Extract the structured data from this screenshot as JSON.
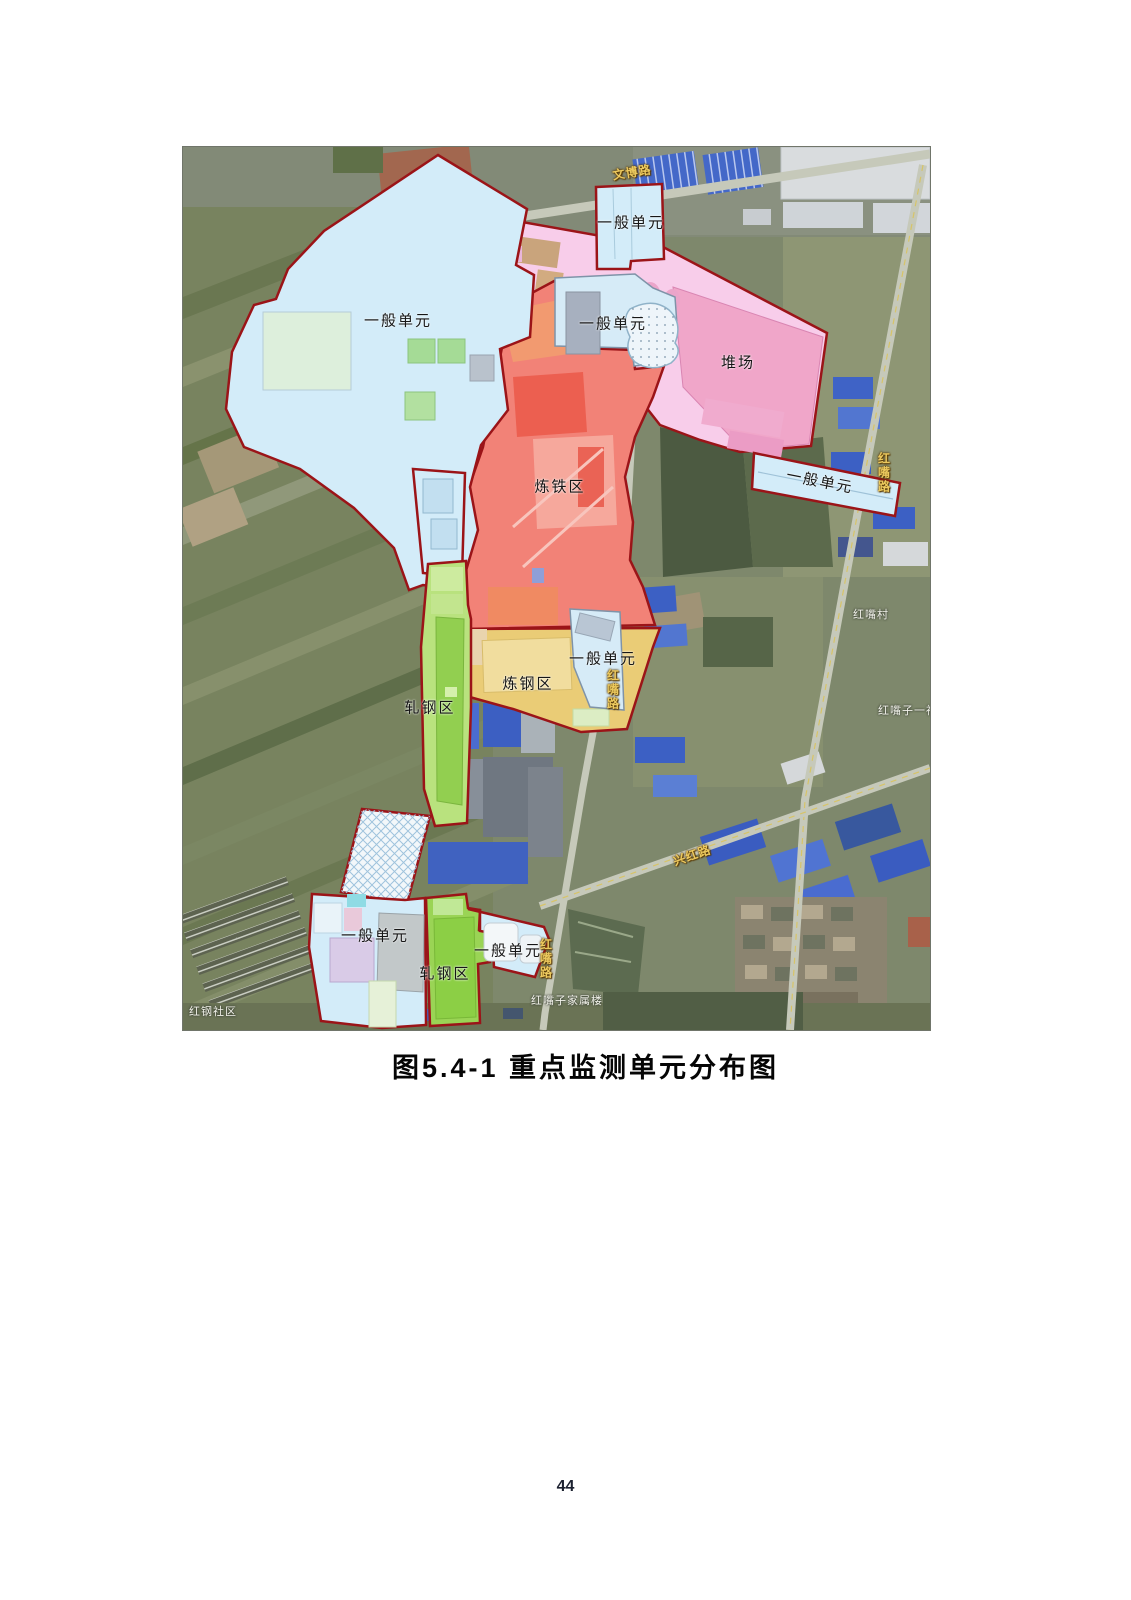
{
  "figure": {
    "caption": "图5.4-1  重点监测单元分布图"
  },
  "page_number": "44",
  "map": {
    "zones": {
      "general_nw": "一般单元",
      "general_top": "一般单元",
      "stockyard": "堆场",
      "general_mid": "一般单元",
      "ironmaking": "炼铁区",
      "general_east": "一般单元",
      "steelmaking": "炼钢区",
      "general_center": "一般单元",
      "rolling_north": "轧钢区",
      "general_south": "一般单元",
      "rolling_south": "轧钢区",
      "general_se": "一般单元"
    },
    "roads": {
      "wenbo": "文博路",
      "hongzui_east": "红嘴路",
      "hongzui_mid": "红嘴路",
      "hongzui_south": "红嘴路",
      "xinghong": "兴红路"
    },
    "places": {
      "hongzui_village": "红嘴村",
      "hongzuizi_yishe": "红嘴子一社",
      "hongzuizi_jiashulou": "红嘴子家属楼",
      "honggang_shequ": "红钢社区"
    },
    "colors": {
      "boundary": "#9b1418",
      "general_unit": "#d3ecf9",
      "stockyard": "#f8cdea",
      "stockyard_dark": "#f0a6c9",
      "ironmaking": "#f28277",
      "steelmaking": "#eacc76",
      "rolling": "#a9dc67"
    }
  }
}
